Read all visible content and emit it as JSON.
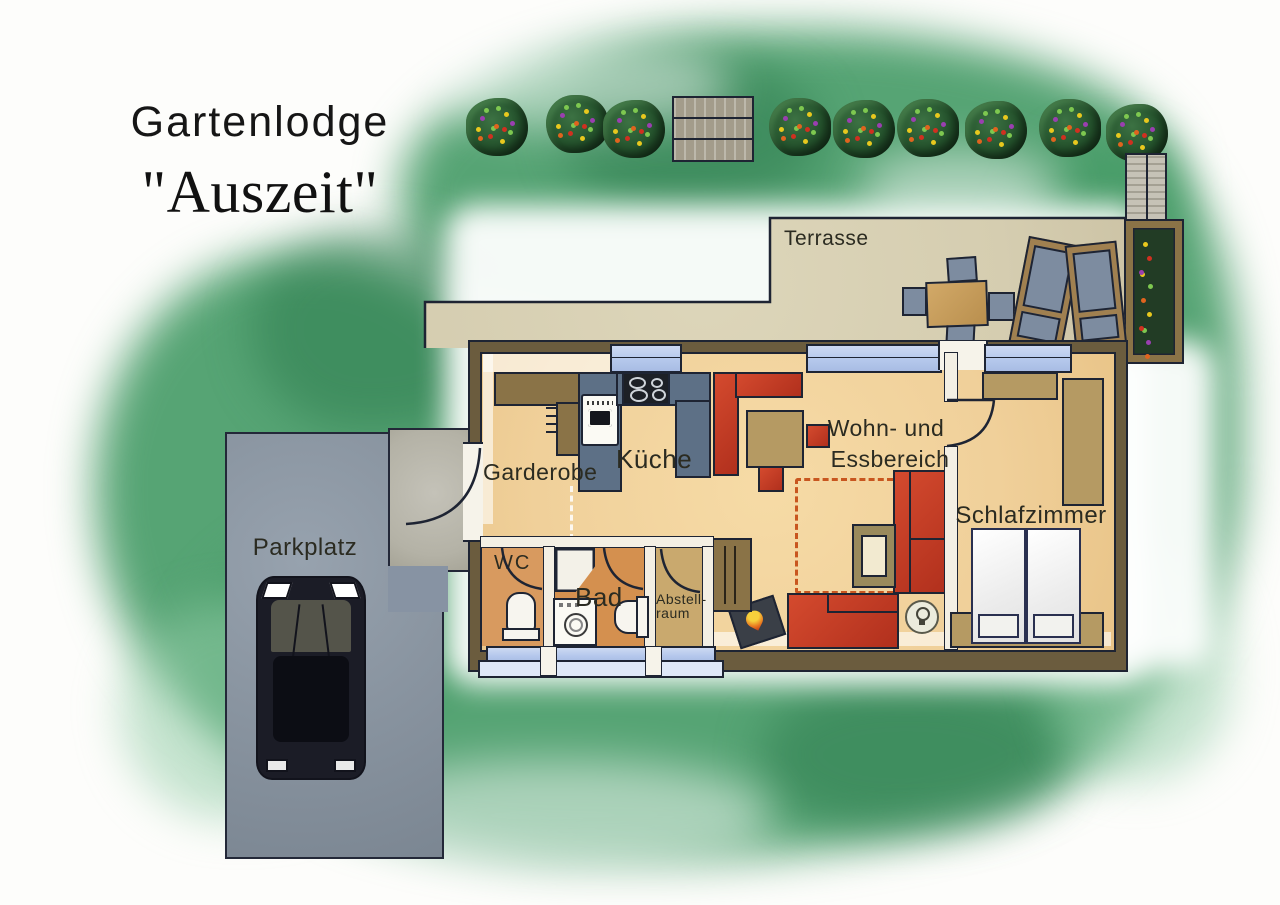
{
  "title": {
    "name": "Gartenlodge",
    "subtitle": "\"Auszeit\""
  },
  "rooms": {
    "terrasse": {
      "label": "Terrasse"
    },
    "garderobe": {
      "label": "Garderobe"
    },
    "kueche": {
      "label": "Küche"
    },
    "wc": {
      "label": "WC"
    },
    "bad": {
      "label": "Bad"
    },
    "abstellraum": {
      "label_line1": "Abstell-",
      "label_line2": "raum"
    },
    "wohn_essbereich": {
      "label_line1": "Wohn- und",
      "label_line2": "Essbereich"
    },
    "schlafzimmer": {
      "label": "Schlafzimmer"
    },
    "parkplatz": {
      "label": "Parkplatz"
    }
  },
  "colors": {
    "garden_green": "#489c68",
    "terrace_beige": "#d8d1b5",
    "floor_sand": "#f2d29b",
    "bathroom_orange": "#d4904f",
    "storage_tan": "#c9a96e",
    "wall_brown": "#6b5c3e",
    "outline_navy": "#1e2433",
    "furniture_red": "#c0392b",
    "kitchen_blue": "#5d7086",
    "window_blue": "#b9ccee",
    "wood_tan": "#8a7347",
    "parking_gray": "#8a95a1",
    "rug_dash_orange": "#c8561f"
  },
  "icons": [
    "flower-bush",
    "wooden-pallet",
    "privacy-screen",
    "flower-planter",
    "terrace-table",
    "terrace-chair",
    "sun-lounger",
    "wardrobe",
    "coat-hooks",
    "oven",
    "stove-burners",
    "corner-bench",
    "dining-table",
    "stool",
    "rug",
    "sofa",
    "coffee-table",
    "wood-stove-flame",
    "lamp",
    "shelf",
    "dresser",
    "closet",
    "double-bed",
    "pillow",
    "toilet",
    "shower",
    "washing-machine",
    "window",
    "door-arc",
    "car"
  ]
}
